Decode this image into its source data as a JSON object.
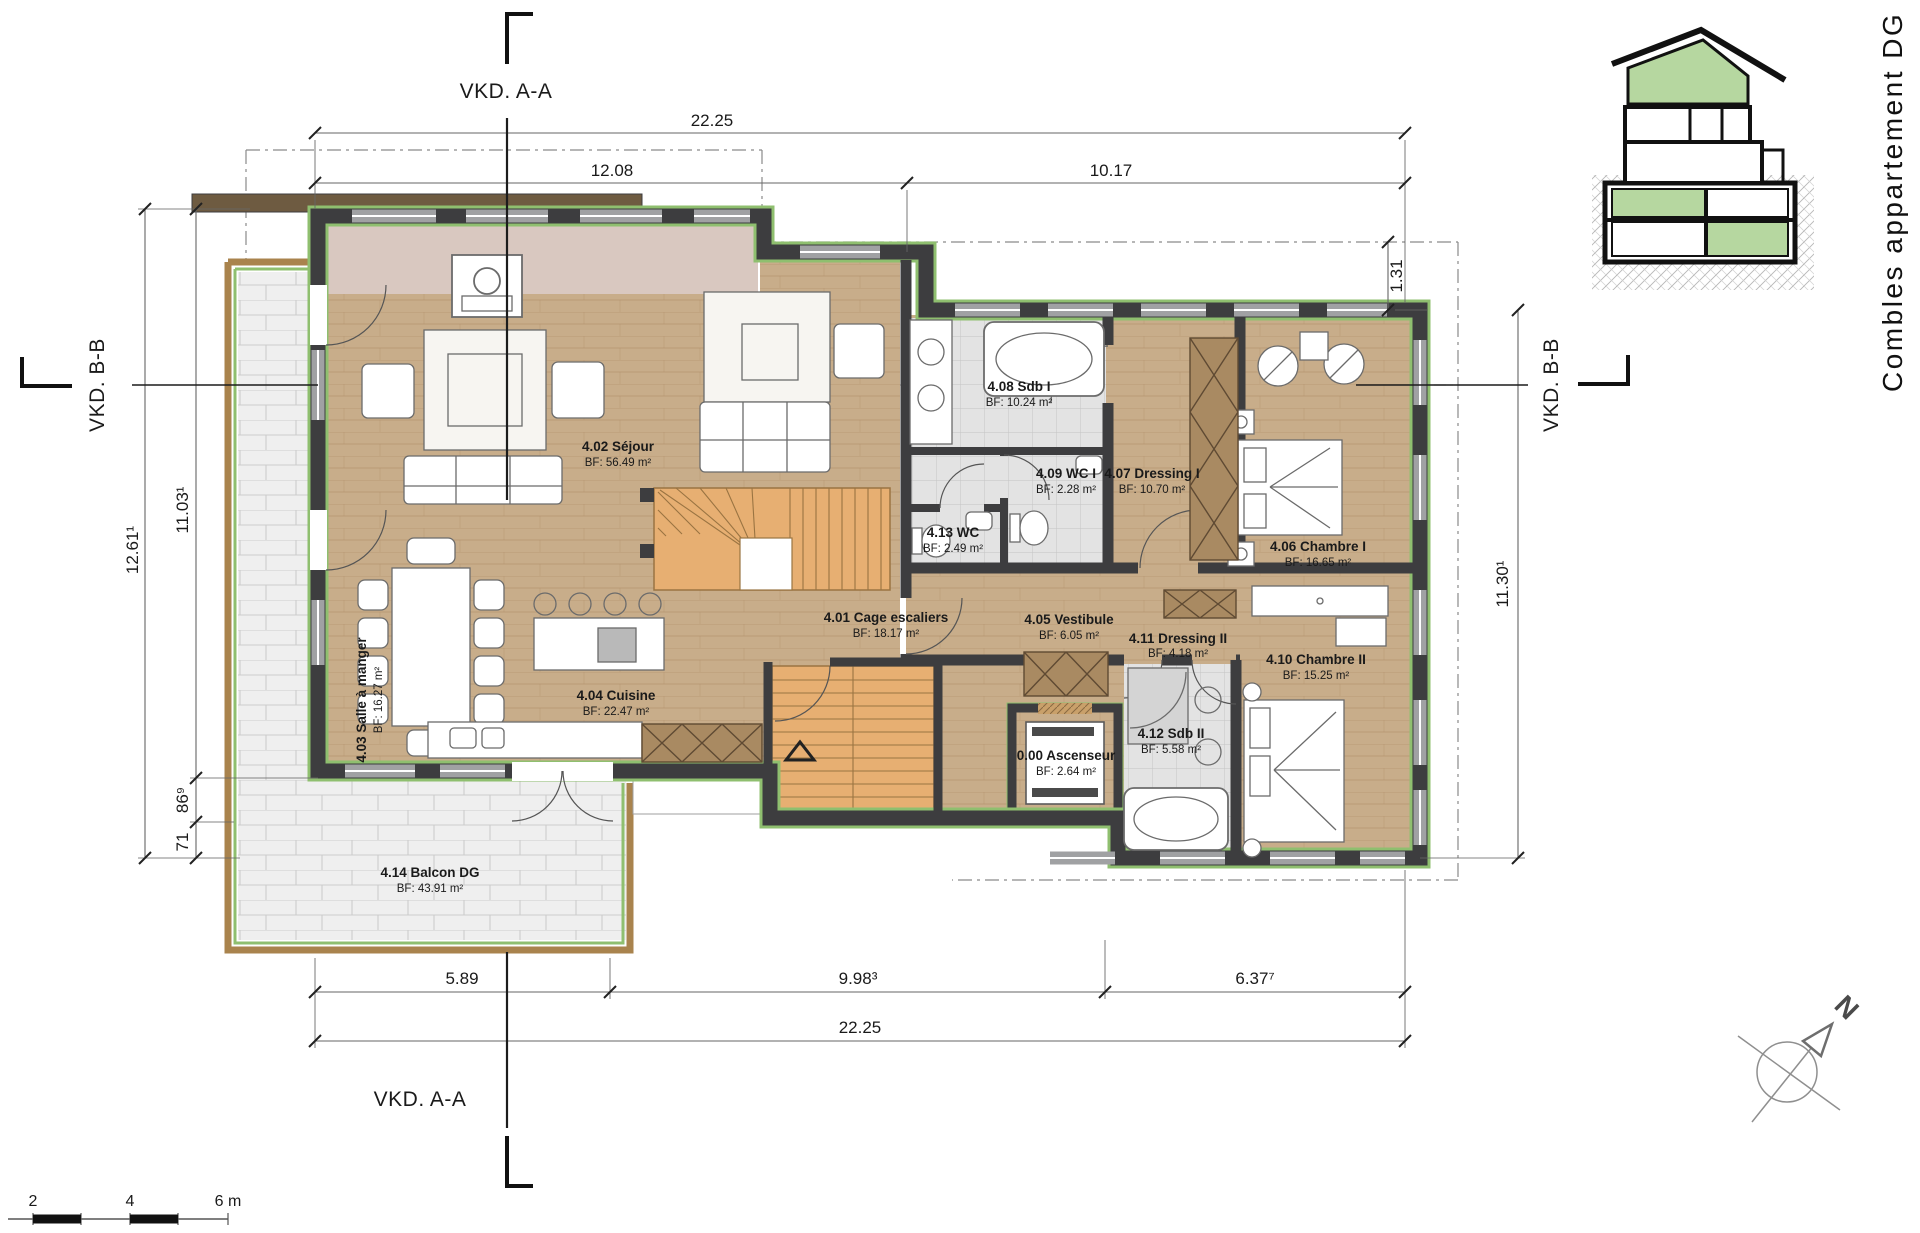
{
  "drawing": {
    "side_title": "Combles appartement DG",
    "north_label": "N"
  },
  "section_marks": {
    "top": "VKD. A-A",
    "bottom": "VKD. A-A",
    "left": "VKD. B-B",
    "right": "VKD. B-B"
  },
  "dimensions": {
    "top_total": "22.25",
    "top_left": "12.08",
    "top_right": "10.17",
    "overhang_right": "1.31",
    "left_outer": "12.61¹",
    "left_inner": "11.03¹",
    "left_small_a": "86⁹",
    "left_small_b": "71",
    "right_side": "11.30¹",
    "bottom_a": "5.89",
    "bottom_b": "9.98³",
    "bottom_c": "6.37⁷",
    "bottom_total": "22.25"
  },
  "rooms": [
    {
      "id": "4.01",
      "label": "4.01  Cage escaliers",
      "area": "BF: 18.17 m²"
    },
    {
      "id": "4.02",
      "label": "4.02  Séjour",
      "area": "BF: 56.49 m²"
    },
    {
      "id": "4.03",
      "label": "4.03  Salle à manger",
      "area": "BF: 16.27 m²"
    },
    {
      "id": "4.04",
      "label": "4.04  Cuisine",
      "area": "BF: 22.47 m²"
    },
    {
      "id": "4.05",
      "label": "4.05  Vestibule",
      "area": "BF: 6.05 m²"
    },
    {
      "id": "4.06",
      "label": "4.06  Chambre I",
      "area": "BF: 16.65 m²"
    },
    {
      "id": "4.07",
      "label": "4.07  Dressing I",
      "area": "BF: 10.70 m²"
    },
    {
      "id": "4.08",
      "label": "4.08  Sdb I",
      "area": "BF: 10.24 m²"
    },
    {
      "id": "4.09",
      "label": "4.09  WC I",
      "area": "BF: 2.28 m²"
    },
    {
      "id": "4.10",
      "label": "4.10  Chambre II",
      "area": "BF: 15.25 m²"
    },
    {
      "id": "4.11",
      "label": "4.11  Dressing II",
      "area": "BF: 4.18 m²"
    },
    {
      "id": "4.12",
      "label": "4.12  Sdb II",
      "area": "BF: 5.58 m²"
    },
    {
      "id": "4.13",
      "label": "4.13  WC",
      "area": "BF: 2.49 m²"
    },
    {
      "id": "4.14",
      "label": "4.14  Balcon DG",
      "area": "BF: 43.91 m²"
    },
    {
      "id": "0.00",
      "label": "0.00  Ascenseur",
      "area": "BF: 2.64 m²"
    }
  ],
  "scale_bar": {
    "tick_2": "2",
    "tick_4": "4",
    "tick_6": "6 m"
  },
  "colors": {
    "wall": "#3d3d3f",
    "floor_wood": "#c8ad8a",
    "tile": "#e3e3e3",
    "balcony_tile": "#efefef",
    "stairs_orange": "#e7af72",
    "insulation_green": "#8fbf6f",
    "section_green": "#b6d7a0",
    "wardrobe_brown": "#a98a62",
    "hearth_pink": "#d9c8c0"
  }
}
